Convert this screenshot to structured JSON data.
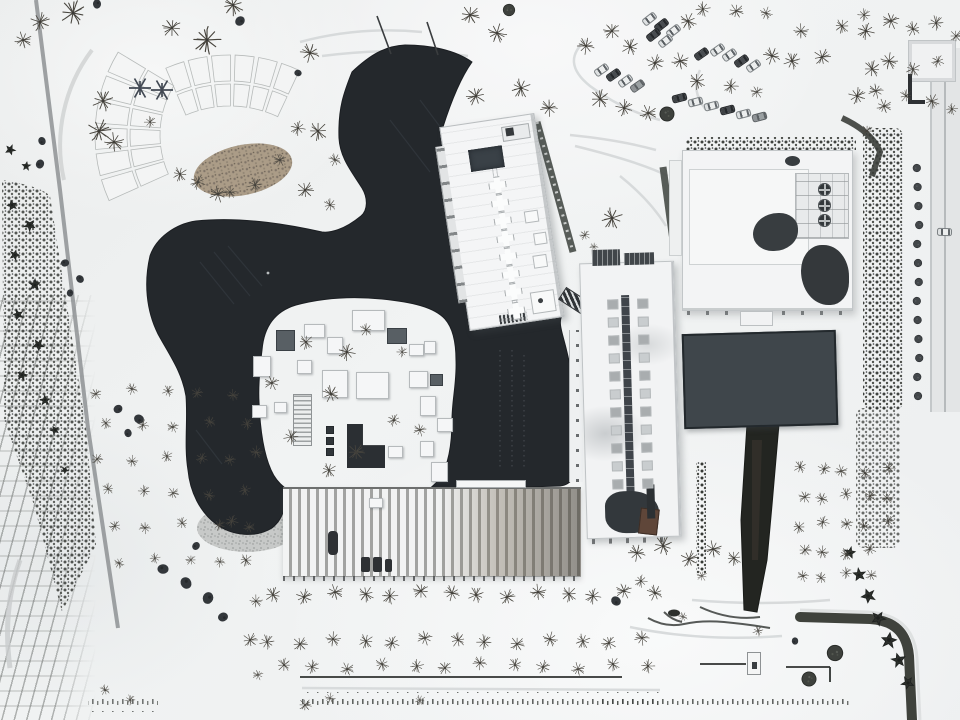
{
  "meta": {
    "description": "Aerial winter drone photograph of a museum campus in snow: a dark free-form pond deck wrapping a sunken courtyard of white rooftop boxes, three white flat-roofed buildings, a long ribbed-roof hall, a dark rectangular reflecting pool, snow-covered parking rows with cars, bare trees, garden arc beds and tree-lined lanes."
  },
  "colors": {
    "snow": "#eff1f2",
    "pond_deck": "#24282c",
    "pond_streak": "#333a40",
    "pool": "#3f464b",
    "roof_white": "#f4f5f6",
    "roof_edge": "#b9bdbf",
    "tree": "#49463f",
    "conifer": "#2d302c",
    "hedge": "#3a3e39",
    "path": "#9aa0a2",
    "stone": "#c7c9c8",
    "soil": "#a3927b",
    "rust_panel": "#5f4639"
  },
  "scene": {
    "trees": [
      [
        73,
        13,
        1.2,
        "b"
      ],
      [
        40,
        22,
        0.9,
        "b"
      ],
      [
        23,
        40,
        0.8,
        "b"
      ],
      [
        233,
        5,
        1.0,
        "b"
      ],
      [
        207,
        40,
        1.3,
        "b"
      ],
      [
        172,
        28,
        0.9,
        "b"
      ],
      [
        310,
        53,
        0.9,
        "b"
      ],
      [
        103,
        101,
        1.0,
        "b"
      ],
      [
        99,
        131,
        1.1,
        "b"
      ],
      [
        114,
        142,
        0.9,
        "b"
      ],
      [
        318,
        131,
        0.9,
        "b"
      ],
      [
        298,
        128,
        0.7,
        "b"
      ],
      [
        280,
        160,
        0.6,
        "b"
      ],
      [
        335,
        160,
        0.6,
        "b"
      ],
      [
        255,
        185,
        0.7,
        "b"
      ],
      [
        305,
        190,
        0.8,
        "b"
      ],
      [
        230,
        192,
        0.6,
        "b"
      ],
      [
        180,
        174,
        0.7,
        "b"
      ],
      [
        198,
        182,
        0.7,
        "b"
      ],
      [
        218,
        194,
        0.8,
        "b"
      ],
      [
        330,
        205,
        0.6,
        "b"
      ],
      [
        150,
        122,
        0.55,
        "b"
      ],
      [
        97,
        4,
        1.0,
        "u"
      ],
      [
        240,
        21,
        1.1,
        "u"
      ],
      [
        298,
        73,
        0.8,
        "u"
      ],
      [
        42,
        141,
        0.9,
        "u"
      ],
      [
        40,
        164,
        1.0,
        "u"
      ],
      [
        65,
        263,
        0.9,
        "u"
      ],
      [
        80,
        279,
        0.9,
        "u"
      ],
      [
        70,
        293,
        0.8,
        "u"
      ],
      [
        118,
        409,
        1.0,
        "u"
      ],
      [
        139,
        419,
        1.1,
        "u"
      ],
      [
        128,
        433,
        0.9,
        "u"
      ],
      [
        196,
        546,
        0.9,
        "u"
      ],
      [
        163,
        569,
        1.2,
        "u"
      ],
      [
        186,
        583,
        1.3,
        "u"
      ],
      [
        208,
        598,
        1.3,
        "u"
      ],
      [
        223,
        617,
        1.1,
        "u"
      ],
      [
        616,
        601,
        1.1,
        "u"
      ],
      [
        795,
        641,
        0.8,
        "u"
      ],
      [
        509,
        10,
        0.9,
        "r"
      ],
      [
        667,
        114,
        1.1,
        "r"
      ],
      [
        809,
        679,
        1.1,
        "r"
      ],
      [
        835,
        653,
        1.2,
        "r"
      ],
      [
        306,
        342,
        0.7,
        "b"
      ],
      [
        347,
        352,
        0.8,
        "b"
      ],
      [
        272,
        383,
        0.7,
        "b"
      ],
      [
        331,
        394,
        0.8,
        "b"
      ],
      [
        291,
        437,
        0.7,
        "b"
      ],
      [
        356,
        452,
        0.8,
        "b"
      ],
      [
        256,
        452,
        0.6,
        "b"
      ],
      [
        329,
        470,
        0.7,
        "b"
      ],
      [
        394,
        420,
        0.6,
        "b"
      ],
      [
        420,
        430,
        0.6,
        "b"
      ],
      [
        366,
        330,
        0.6,
        "b"
      ],
      [
        402,
        352,
        0.5,
        "b"
      ],
      [
        470,
        15,
        0.9,
        "b"
      ],
      [
        497,
        33,
        0.9,
        "b"
      ],
      [
        521,
        88,
        0.9,
        "b"
      ],
      [
        476,
        96,
        0.9,
        "b"
      ],
      [
        549,
        108,
        0.8,
        "b"
      ],
      [
        600,
        99,
        0.9,
        "b"
      ],
      [
        624,
        108,
        0.8,
        "b"
      ],
      [
        648,
        113,
        0.8,
        "b"
      ],
      [
        688,
        21,
        0.8,
        "b"
      ],
      [
        703,
        9,
        0.7,
        "b"
      ],
      [
        612,
        31,
        0.8,
        "b"
      ],
      [
        586,
        46,
        0.8,
        "b"
      ],
      [
        630,
        47,
        0.8,
        "b"
      ],
      [
        655,
        63,
        0.8,
        "b"
      ],
      [
        680,
        61,
        0.8,
        "b"
      ],
      [
        697,
        81,
        0.8,
        "b"
      ],
      [
        731,
        86,
        0.7,
        "b"
      ],
      [
        757,
        92,
        0.6,
        "b"
      ],
      [
        772,
        56,
        0.8,
        "b"
      ],
      [
        792,
        61,
        0.8,
        "b"
      ],
      [
        822,
        57,
        0.8,
        "b"
      ],
      [
        801,
        31,
        0.7,
        "b"
      ],
      [
        842,
        26,
        0.7,
        "b"
      ],
      [
        866,
        31,
        0.8,
        "b"
      ],
      [
        891,
        21,
        0.8,
        "b"
      ],
      [
        913,
        29,
        0.7,
        "b"
      ],
      [
        936,
        23,
        0.7,
        "b"
      ],
      [
        956,
        36,
        0.6,
        "b"
      ],
      [
        889,
        61,
        0.8,
        "b"
      ],
      [
        913,
        69,
        0.7,
        "b"
      ],
      [
        938,
        61,
        0.6,
        "b"
      ],
      [
        876,
        91,
        0.7,
        "b"
      ],
      [
        906,
        96,
        0.6,
        "b"
      ],
      [
        864,
        15,
        0.6,
        "b"
      ],
      [
        736,
        11,
        0.7,
        "b"
      ],
      [
        766,
        13,
        0.6,
        "b"
      ],
      [
        612,
        218,
        1.0,
        "b"
      ],
      [
        585,
        235,
        0.5,
        "b"
      ],
      [
        594,
        247,
        0.4,
        "b"
      ],
      [
        872,
        69,
        0.8,
        "b"
      ],
      [
        857,
        96,
        0.8,
        "b"
      ],
      [
        884,
        106,
        0.7,
        "b"
      ],
      [
        932,
        101,
        0.7,
        "b"
      ],
      [
        952,
        109,
        0.55,
        "b"
      ],
      [
        867,
        131,
        0.6,
        "b"
      ],
      [
        637,
        553,
        0.8,
        "b"
      ],
      [
        663,
        546,
        0.9,
        "b"
      ],
      [
        689,
        559,
        0.8,
        "b"
      ],
      [
        713,
        549,
        0.8,
        "b"
      ],
      [
        734,
        558,
        0.7,
        "b"
      ],
      [
        641,
        581,
        0.6,
        "b"
      ],
      [
        702,
        576,
        0.5,
        "b"
      ],
      [
        683,
        617,
        0.45,
        "b"
      ],
      [
        758,
        631,
        0.5,
        "b"
      ],
      [
        250,
        640,
        0.7,
        "b"
      ],
      [
        256,
        601,
        0.6,
        "b"
      ],
      [
        246,
        560,
        0.6,
        "b"
      ],
      [
        232,
        521,
        0.6,
        "b"
      ],
      [
        258,
        675,
        0.5,
        "b"
      ],
      [
        105,
        690,
        0.5,
        "b"
      ],
      [
        130,
        700,
        0.5,
        "b"
      ],
      [
        305,
        705,
        0.6,
        "b"
      ],
      [
        330,
        698,
        0.5,
        "b"
      ],
      [
        420,
        700,
        0.5,
        "b"
      ],
      [
        10,
        150,
        0.8,
        "c"
      ],
      [
        26,
        166,
        0.7,
        "c"
      ],
      [
        12,
        205,
        0.8,
        "c"
      ],
      [
        30,
        225,
        0.9,
        "c"
      ],
      [
        15,
        255,
        0.8,
        "c"
      ],
      [
        35,
        285,
        0.9,
        "c"
      ],
      [
        18,
        315,
        0.8,
        "c"
      ],
      [
        38,
        345,
        0.9,
        "c"
      ],
      [
        22,
        375,
        0.8,
        "c"
      ],
      [
        45,
        400,
        0.8,
        "c"
      ],
      [
        55,
        430,
        0.7,
        "c"
      ],
      [
        65,
        470,
        0.6,
        "c"
      ],
      [
        850,
        553,
        0.9,
        "c"
      ],
      [
        859,
        575,
        1.0,
        "c"
      ],
      [
        868,
        596,
        1.1,
        "c"
      ],
      [
        878,
        618,
        1.1,
        "c"
      ],
      [
        889,
        640,
        1.2,
        "c"
      ],
      [
        899,
        660,
        1.1,
        "c"
      ],
      [
        908,
        683,
        1.0,
        "c"
      ]
    ],
    "tree_rows": [
      {
        "y": 594,
        "x0": 276,
        "x1": 654,
        "step": 29,
        "s": 0.75,
        "kind": "b"
      },
      {
        "y": 641,
        "x0": 270,
        "x1": 658,
        "step": 31,
        "s": 0.7,
        "kind": "b"
      },
      {
        "y": 666,
        "x0": 282,
        "x1": 652,
        "step": 33,
        "s": 0.65,
        "kind": "b"
      },
      {
        "y": 392,
        "x0": 98,
        "x1": 240,
        "step": 34,
        "s": 0.55,
        "kind": "b"
      },
      {
        "y": 425,
        "x0": 105,
        "x1": 245,
        "step": 35,
        "s": 0.55,
        "kind": "b"
      },
      {
        "y": 458,
        "x0": 100,
        "x1": 248,
        "step": 33,
        "s": 0.55,
        "kind": "b"
      },
      {
        "y": 492,
        "x0": 108,
        "x1": 250,
        "step": 34,
        "s": 0.55,
        "kind": "b"
      },
      {
        "y": 526,
        "x0": 112,
        "x1": 252,
        "step": 35,
        "s": 0.55,
        "kind": "b"
      },
      {
        "y": 560,
        "x0": 120,
        "x1": 255,
        "step": 34,
        "s": 0.5,
        "kind": "b"
      },
      {
        "y": 470,
        "x0": 800,
        "x1": 888,
        "step": 22,
        "s": 0.6,
        "kind": "b"
      },
      {
        "y": 497,
        "x0": 802,
        "x1": 890,
        "step": 22,
        "s": 0.6,
        "kind": "b"
      },
      {
        "y": 524,
        "x0": 800,
        "x1": 888,
        "step": 22,
        "s": 0.6,
        "kind": "b"
      },
      {
        "y": 551,
        "x0": 803,
        "x1": 890,
        "step": 22,
        "s": 0.6,
        "kind": "b"
      },
      {
        "y": 576,
        "x0": 800,
        "x1": 886,
        "step": 23,
        "s": 0.55,
        "kind": "b"
      }
    ],
    "tree_cols": [
      {
        "x": 918,
        "y0": 168,
        "y1": 400,
        "step": 19,
        "s": 0.9,
        "kind": "m"
      }
    ],
    "cars": [
      [
        642,
        15,
        -38,
        "s"
      ],
      [
        654,
        21,
        -38,
        "d"
      ],
      [
        666,
        27,
        -38,
        "s"
      ],
      [
        646,
        31,
        -38,
        "d"
      ],
      [
        658,
        37,
        -38,
        "s"
      ],
      [
        694,
        50,
        -35,
        "d"
      ],
      [
        710,
        46,
        -35,
        "s"
      ],
      [
        722,
        51,
        -35,
        "s"
      ],
      [
        734,
        57,
        -35,
        "d"
      ],
      [
        746,
        62,
        -35,
        "s"
      ],
      [
        594,
        66,
        -35,
        "s"
      ],
      [
        606,
        71,
        -35,
        "d"
      ],
      [
        618,
        77,
        -35,
        "s"
      ],
      [
        630,
        82,
        -35,
        "m"
      ],
      [
        672,
        94,
        -15,
        "d"
      ],
      [
        688,
        98,
        -15,
        "s"
      ],
      [
        704,
        102,
        -15,
        "s"
      ],
      [
        720,
        106,
        -15,
        "d"
      ],
      [
        736,
        110,
        -15,
        "s"
      ],
      [
        752,
        113,
        -15,
        "m"
      ],
      [
        937,
        228,
        2,
        "s"
      ]
    ],
    "courtyard_boxes": [
      [
        352,
        310,
        33,
        21,
        "w"
      ],
      [
        304,
        324,
        21,
        14,
        "w"
      ],
      [
        327,
        337,
        16,
        17,
        "w"
      ],
      [
        276,
        330,
        19,
        21,
        "d"
      ],
      [
        387,
        328,
        20,
        16,
        "d"
      ],
      [
        409,
        344,
        15,
        12,
        "w"
      ],
      [
        253,
        356,
        18,
        21,
        "w"
      ],
      [
        297,
        360,
        15,
        14,
        "w"
      ],
      [
        322,
        370,
        26,
        28,
        "w"
      ],
      [
        356,
        372,
        33,
        27,
        "w"
      ],
      [
        409,
        371,
        19,
        17,
        "w"
      ],
      [
        424,
        341,
        12,
        13,
        "w"
      ],
      [
        430,
        374,
        13,
        12,
        "d"
      ],
      [
        420,
        396,
        16,
        20,
        "w"
      ],
      [
        437,
        418,
        16,
        14,
        "w"
      ],
      [
        420,
        441,
        14,
        16,
        "w"
      ],
      [
        431,
        462,
        17,
        20,
        "w"
      ],
      [
        252,
        405,
        15,
        13,
        "w"
      ],
      [
        274,
        402,
        13,
        11,
        "w"
      ],
      [
        293,
        394,
        19,
        52,
        "rb"
      ],
      [
        347,
        424,
        38,
        44,
        "dl"
      ],
      [
        326,
        426,
        8,
        8,
        "dd"
      ],
      [
        326,
        437,
        8,
        8,
        "dd"
      ],
      [
        326,
        448,
        8,
        8,
        "dd"
      ],
      [
        388,
        446,
        15,
        12,
        "w"
      ],
      [
        369,
        498,
        14,
        10,
        "w"
      ]
    ],
    "tilted_building": {
      "cross_ys": [
        56,
        74,
        92,
        110,
        128,
        146,
        164,
        183
      ],
      "cross_x": 39
    },
    "vertical_building": {
      "pod_ys": [
        36,
        54,
        72,
        90,
        108,
        126,
        144,
        162,
        180,
        198,
        216
      ],
      "pod_xs": [
        26,
        56
      ]
    },
    "garden_bands": [
      {
        "cx": 230,
        "cy": 218,
        "a0": -114,
        "a1": -64,
        "segs": 6,
        "rows": [
          [
            112,
            134
          ],
          [
            137,
            163
          ]
        ]
      },
      {
        "cx": 255,
        "cy": 135,
        "a0": 155,
        "a1": 212,
        "segs": 6,
        "rows": [
          [
            95,
            125
          ],
          [
            128,
            160
          ]
        ]
      }
    ]
  }
}
